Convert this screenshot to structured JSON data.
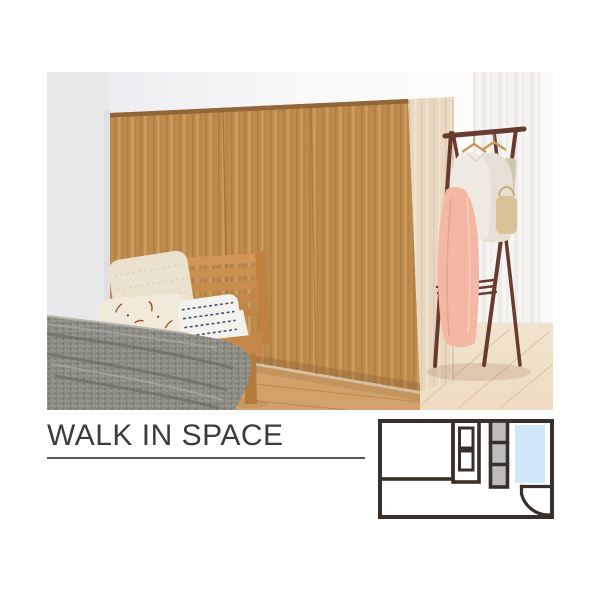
{
  "page": {
    "background": "#ffffff"
  },
  "caption": {
    "title": "WALK IN SPACE",
    "title_color": "#3c3c3e",
    "rule_color": "#55555a"
  },
  "floor_plan": {
    "wall_color": "#38302a",
    "walk_in_highlight_color": "#cfe7f7",
    "cabinet_fill_color": "#bdbdbd",
    "floor_fill_color": "#ffffff",
    "areas": [
      "bedroom-area",
      "shelf-unit",
      "cabinet-column",
      "walk-in-space",
      "door-swing"
    ]
  },
  "photo": {
    "wood_color": "#bf8b4c",
    "side_panel_color": "#e8d8c1",
    "rack_color": "#693a30",
    "blanket_color": "#8b8a83",
    "dress_color": "#f3b7a3",
    "highlight_floor_color": "#efe0c9"
  }
}
